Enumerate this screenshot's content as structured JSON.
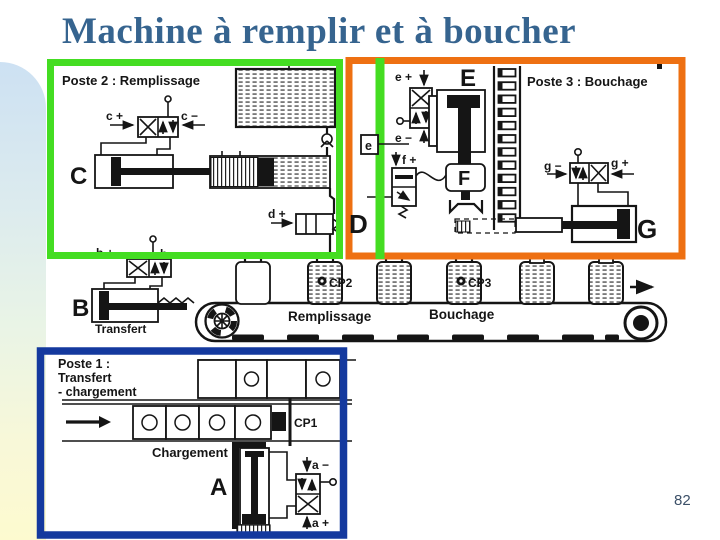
{
  "slide": {
    "title": "Machine à remplir et à boucher",
    "page_number": "82"
  },
  "colors": {
    "box_green": "#44dd22",
    "box_orange": "#ee7012",
    "box_blue": "#14399e",
    "title_blue": "#36648f"
  },
  "poste2": {
    "title": "Poste 2 : Remplissage",
    "cylinder_label": "C",
    "valve_plus_label": "c +",
    "valve_minus_label": "c −",
    "dose_valve_label": "d +",
    "doser_label": "D"
  },
  "poste3": {
    "title": "Poste 3 : Bouchage",
    "press_cylinder_label": "E",
    "valve_e_plus_label": "e +",
    "valve_e_minus_label": "e −",
    "sensor_e_label": "e",
    "gripper_label": "F",
    "valve_f_plus_label": "f +",
    "valve_g_minus_label": "g −",
    "valve_g_plus_label": "g +",
    "push_cylinder_label": "G"
  },
  "conveyor": {
    "transfer_cylinder_label": "B",
    "valve_plus_label": "b +",
    "valve_minus_label": "b −",
    "transfer_label": "Transfert",
    "fill_zone_label": "Remplissage",
    "cap_zone_label": "Bouchage",
    "fill_sensor_label": "CP2",
    "cap_sensor_label": "CP3"
  },
  "poste1": {
    "title_line1": "Poste 1 :",
    "title_line2": "Transfert",
    "title_line3": "- chargement",
    "load_label": "Chargement",
    "load_cylinder_label": "A",
    "sensor_label": "CP1",
    "valve_minus_label": "a −",
    "valve_plus_label": "a +"
  }
}
